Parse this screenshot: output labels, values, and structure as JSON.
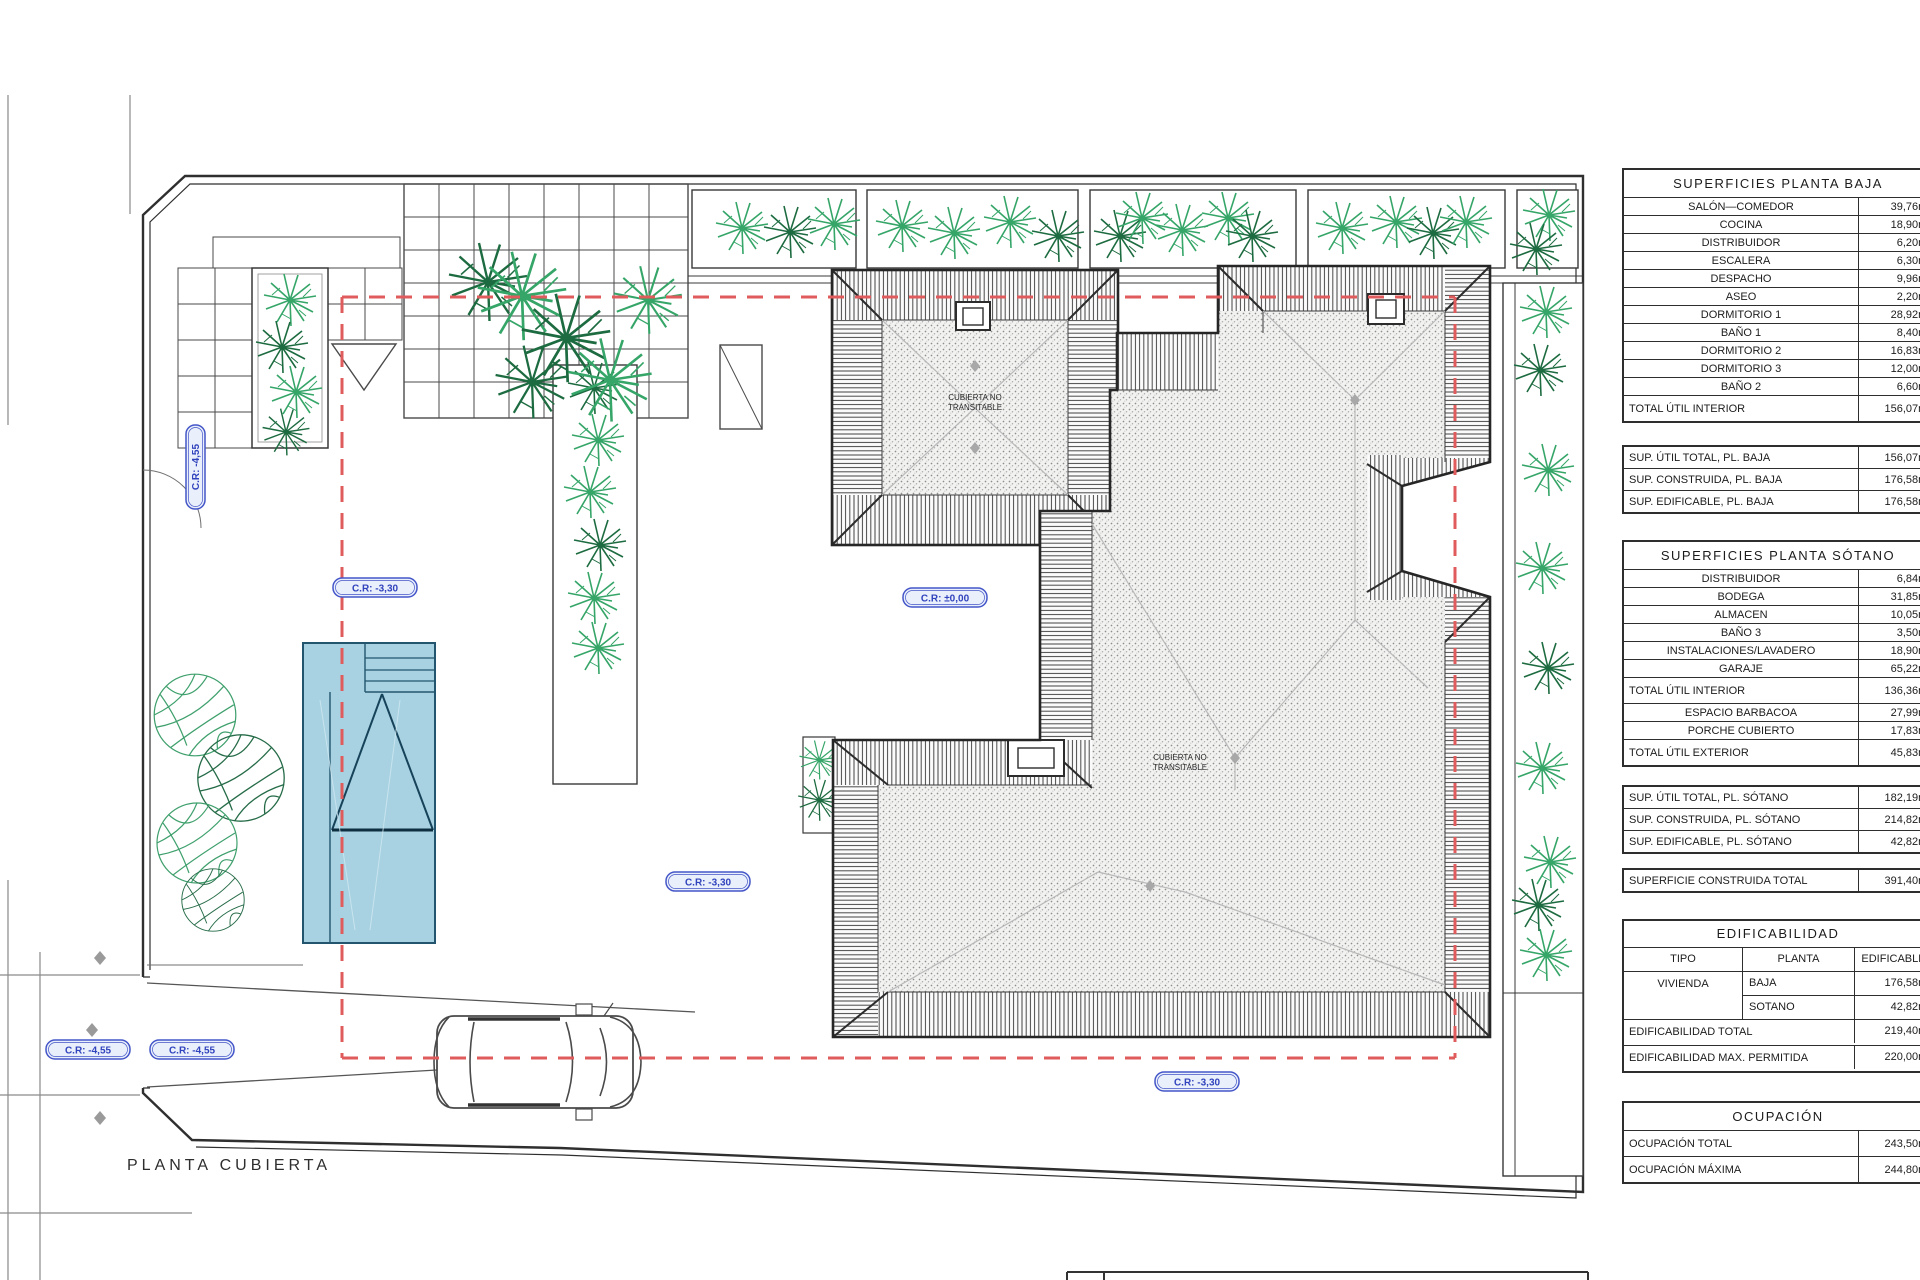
{
  "plan": {
    "title": "PLANTA CUBIERTA",
    "roof_note_line1": "CUBIERTA NO",
    "roof_note_line2": "TRANSITABLE",
    "levels": {
      "l_455": "C.R: -4,55",
      "l_330": "C.R: -3,30",
      "l_000": "C.R: ±0,00"
    },
    "colors": {
      "red_dash": "#e05b5b",
      "pool_fill": "#a8d2e2",
      "pool_stroke": "#23566e",
      "plant_light": "#35a568",
      "plant_dark": "#1d6b40",
      "pill_stroke": "#4456c8",
      "pill_fill": "#e9effb",
      "pill_text": "#3143bd",
      "line": "#383838"
    }
  },
  "area_tables": [
    {
      "blocks": [
        {
          "kind": "box",
          "rows": [
            {
              "t": "header",
              "label": "SUPERFICIES  PLANTA  BAJA"
            },
            {
              "t": "room",
              "label": "SALÓN—COMEDOR",
              "value": "39,76m²"
            },
            {
              "t": "room",
              "label": "COCINA",
              "value": "18,90m²"
            },
            {
              "t": "room",
              "label": "DISTRIBUIDOR",
              "value": "6,20m²"
            },
            {
              "t": "room",
              "label": "ESCALERA",
              "value": "6,30m²"
            },
            {
              "t": "room",
              "label": "DESPACHO",
              "value": "9,96m²"
            },
            {
              "t": "room",
              "label": "ASEO",
              "value": "2,20m²"
            },
            {
              "t": "room",
              "label": "DORMITORIO 1",
              "value": "28,92m²"
            },
            {
              "t": "room",
              "label": "BAÑO 1",
              "value": "8,40m²"
            },
            {
              "t": "room",
              "label": "DORMITORIO 2",
              "value": "16,83m²"
            },
            {
              "t": "room",
              "label": "DORMITORIO 3",
              "value": "12,00m²"
            },
            {
              "t": "room",
              "label": "BAÑO 2",
              "value": "6,60m²"
            },
            {
              "t": "total",
              "label": "TOTAL ÚTIL INTERIOR",
              "value": "156,07m²"
            }
          ]
        },
        {
          "kind": "gap",
          "h": 22
        },
        {
          "kind": "box",
          "rows": [
            {
              "t": "sup",
              "label": "SUP. ÚTIL TOTAL, PL. BAJA",
              "value": "156,07m²"
            },
            {
              "t": "sup",
              "label": "SUP. CONSTRUIDA, PL. BAJA",
              "value": "176,58m²"
            },
            {
              "t": "sup",
              "label": "SUP. EDIFICABLE, PL. BAJA",
              "value": "176,58m²"
            }
          ]
        },
        {
          "kind": "gap",
          "h": 26
        },
        {
          "kind": "box",
          "rows": [
            {
              "t": "header",
              "label": "SUPERFICIES  PLANTA  SÓTANO"
            },
            {
              "t": "room",
              "label": "DISTRIBUIDOR",
              "value": "6,84m²"
            },
            {
              "t": "room",
              "label": "BODEGA",
              "value": "31,85m²"
            },
            {
              "t": "room",
              "label": "ALMACEN",
              "value": "10,05m²"
            },
            {
              "t": "room",
              "label": "BAÑO 3",
              "value": "3,50m²"
            },
            {
              "t": "room",
              "label": "INSTALACIONES/LAVADERO",
              "value": "18,90m²"
            },
            {
              "t": "room",
              "label": "GARAJE",
              "value": "65,22m²"
            },
            {
              "t": "total",
              "label": "TOTAL ÚTIL INTERIOR",
              "value": "136,36m²"
            },
            {
              "t": "room",
              "label": "ESPACIO BARBACOA",
              "value": "27,99m²"
            },
            {
              "t": "room",
              "label": "PORCHE CUBIERTO",
              "value": "17,83m²"
            },
            {
              "t": "total",
              "label": "TOTAL ÚTIL EXTERIOR",
              "value": "45,83m²"
            }
          ]
        },
        {
          "kind": "gap",
          "h": 18
        },
        {
          "kind": "box",
          "rows": [
            {
              "t": "sup",
              "label": "SUP. ÚTIL TOTAL, PL. SÓTANO",
              "value": "182,19m²"
            },
            {
              "t": "sup",
              "label": "SUP. CONSTRUIDA, PL. SÓTANO",
              "value": "214,82m²"
            },
            {
              "t": "sup",
              "label": "SUP. EDIFICABLE, PL. SÓTANO",
              "value": "42,82m²"
            }
          ]
        },
        {
          "kind": "gap",
          "h": 14
        },
        {
          "kind": "box",
          "rows": [
            {
              "t": "sup",
              "label": "SUPERFICIE CONSTRUIDA TOTAL",
              "value": "391,40m²"
            }
          ]
        },
        {
          "kind": "gap",
          "h": 26
        },
        {
          "kind": "edif"
        },
        {
          "kind": "gap",
          "h": 28
        },
        {
          "kind": "box",
          "rows": [
            {
              "t": "header",
              "label": "OCUPACIÓN"
            },
            {
              "t": "total",
              "label": "OCUPACIÓN TOTAL",
              "value": "243,50m²"
            },
            {
              "t": "total",
              "label": "OCUPACIÓN MÁXIMA",
              "value": "244,80m²"
            }
          ]
        }
      ]
    }
  ],
  "edificabilidad": {
    "title": "EDIFICABILIDAD",
    "headers": [
      "TIPO",
      "PLANTA",
      "EDIFICABLE"
    ],
    "tipo": "VIVIENDA",
    "rows": [
      {
        "planta": "BAJA",
        "value": "176,58m²"
      },
      {
        "planta": "SOTANO",
        "value": "42,82m²"
      }
    ],
    "totals": [
      {
        "label": "EDIFICABILIDAD TOTAL",
        "value": "219,40m²"
      },
      {
        "label": "EDIFICABILIDAD MAX. PERMITIDA",
        "value": "220,00m²"
      }
    ]
  }
}
